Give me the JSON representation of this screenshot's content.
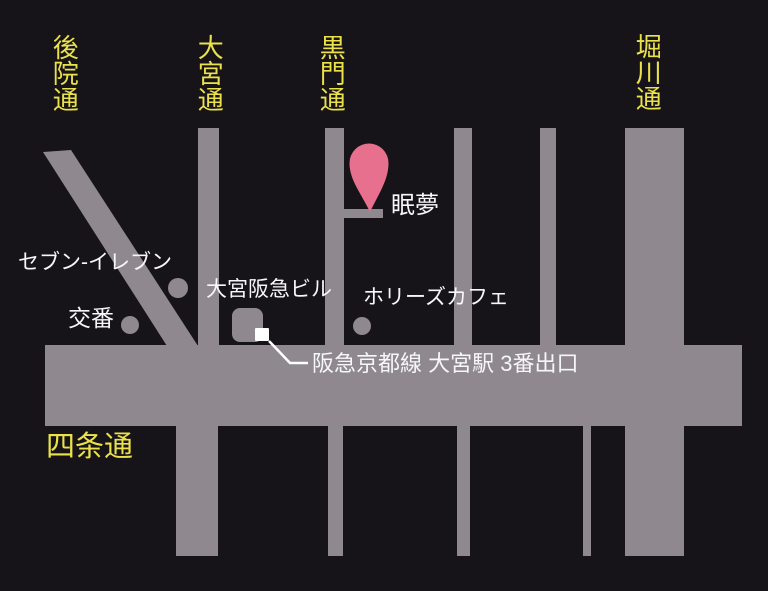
{
  "map": {
    "title": "眠夢 アクセスマップ",
    "streets": {
      "vertical": [
        {
          "name": "後院通"
        },
        {
          "name": "大宮通"
        },
        {
          "name": "黒門通"
        },
        {
          "name": "堀川通"
        }
      ],
      "horizontal": {
        "name": "四条通"
      }
    },
    "destination": {
      "label": "眠夢"
    },
    "pois": [
      {
        "label": "セブン-イレブン",
        "marker": "dot"
      },
      {
        "label": "交番",
        "marker": "dot"
      },
      {
        "label": "大宮阪急ビル",
        "marker": "building"
      },
      {
        "label": "ホリーズカフェ",
        "marker": "dot"
      }
    ],
    "station_exit": {
      "label": "阪急京都線 大宮駅 3番出口",
      "marker": "white-square"
    },
    "colors": {
      "background": "#171419",
      "road": "#8f898f",
      "street_label": "#ebe24b",
      "poi_label": "#f7f6f8",
      "pin": "#e7708f",
      "exit_marker": "#ffffff"
    }
  }
}
